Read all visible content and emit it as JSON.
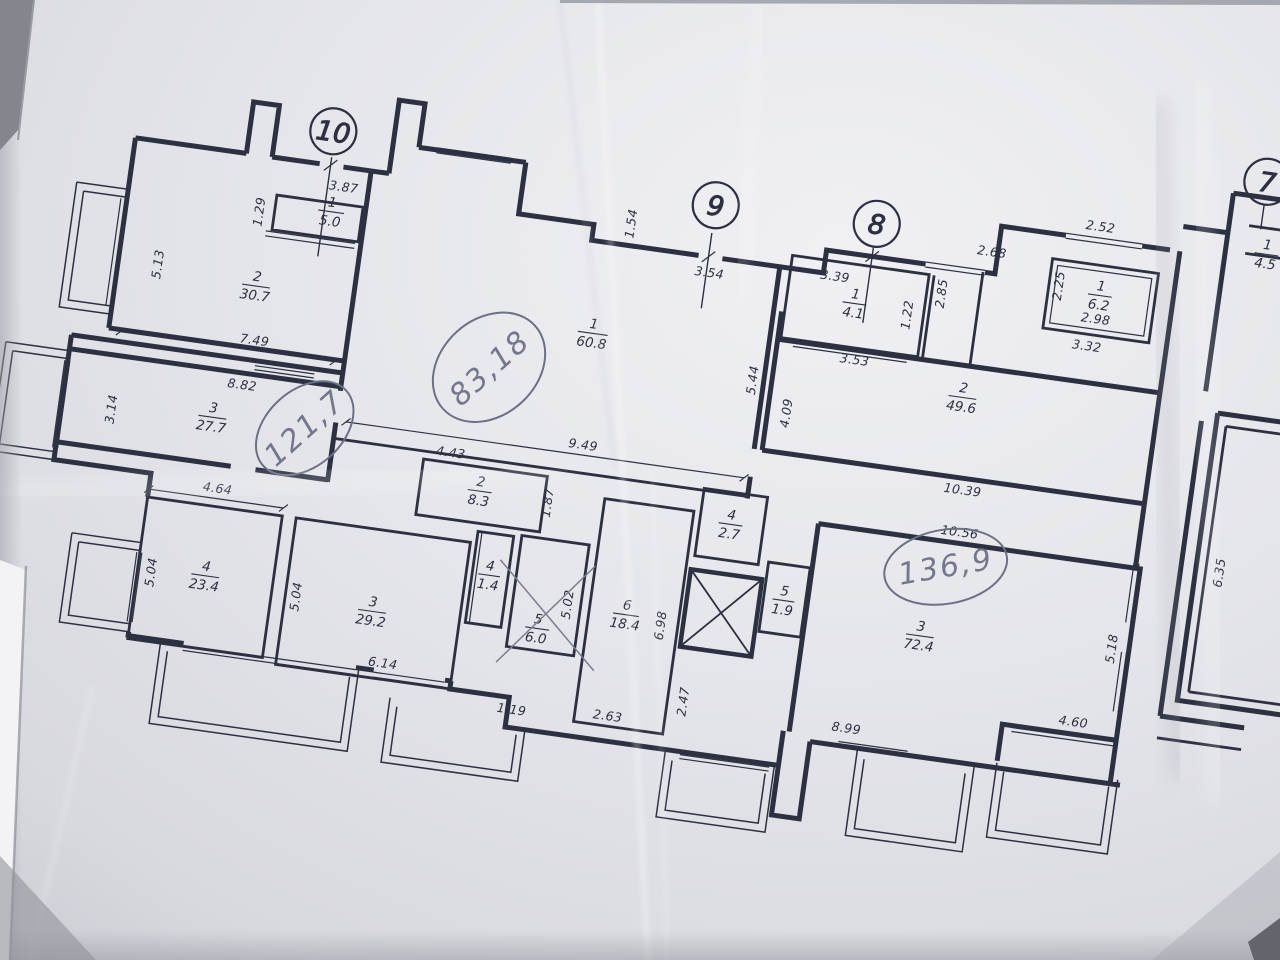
{
  "plan": {
    "sections": {
      "s10": "10",
      "s9": "9",
      "s8": "8",
      "s7": "7"
    },
    "rooms": {
      "a10_r1": {
        "num": "1",
        "area": "5.0"
      },
      "a10_r2": {
        "num": "2",
        "area": "30.7"
      },
      "a10_r3": {
        "num": "3",
        "area": "27.7"
      },
      "a10_r4": {
        "num": "4",
        "area": "23.4"
      },
      "a10_r3b": {
        "num": "3",
        "area": "29.2"
      },
      "a9_r2": {
        "num": "2",
        "area": "8.3"
      },
      "a9_r4c": {
        "num": "4",
        "area": "1.4"
      },
      "a9_r5c": {
        "num": "5",
        "area": "6.0"
      },
      "a9_r6": {
        "num": "6",
        "area": "18.4"
      },
      "a9_r1": {
        "num": "1",
        "area": "60.8"
      },
      "a9_r4": {
        "num": "4",
        "area": "2.7"
      },
      "a9_r5": {
        "num": "5",
        "area": "1.9"
      },
      "a8_r1": {
        "num": "1",
        "area": "4.1"
      },
      "a8_r2": {
        "num": "2",
        "area": "49.6"
      },
      "a8_r1b": {
        "num": "1",
        "area": "6.2"
      },
      "a8_r3": {
        "num": "3",
        "area": "72.4"
      },
      "a7_r1": {
        "num": "1",
        "area": "4.5"
      }
    },
    "dims": {
      "d387": "3.87",
      "d129": "1.29",
      "d513": "5.13",
      "d749": "7.49",
      "d882": "8.82",
      "d314": "3.14",
      "d464": "4.64",
      "d504a": "5.04",
      "d504b": "5.04",
      "d614": "6.14",
      "d119": "1.19",
      "d443": "4.43",
      "d187": "1.87",
      "d502": "5.02",
      "d949": "9.49",
      "d263": "2.63",
      "d698": "6.98",
      "d247": "2.47",
      "d154": "1.54",
      "d354": "3.54",
      "d339": "3.39",
      "d353": "3.53",
      "d122": "1.22",
      "d285": "2.85",
      "d268": "2.68",
      "d252": "2.52",
      "d225": "2.25",
      "d298": "2.98",
      "d332": "3.32",
      "d544": "5.44",
      "d409": "4.09",
      "d1039": "10.39",
      "d1056": "10.56",
      "d518": "5.18",
      "d460": "4.60",
      "d899": "8.99",
      "d635": "6.35"
    },
    "handwritten": {
      "total10": "121,7",
      "total9": "83,18",
      "total8": "136,9"
    },
    "colors": {
      "ink": "#2c3040",
      "pencil": "#6b7084",
      "paper": "#e4e5ea"
    }
  }
}
